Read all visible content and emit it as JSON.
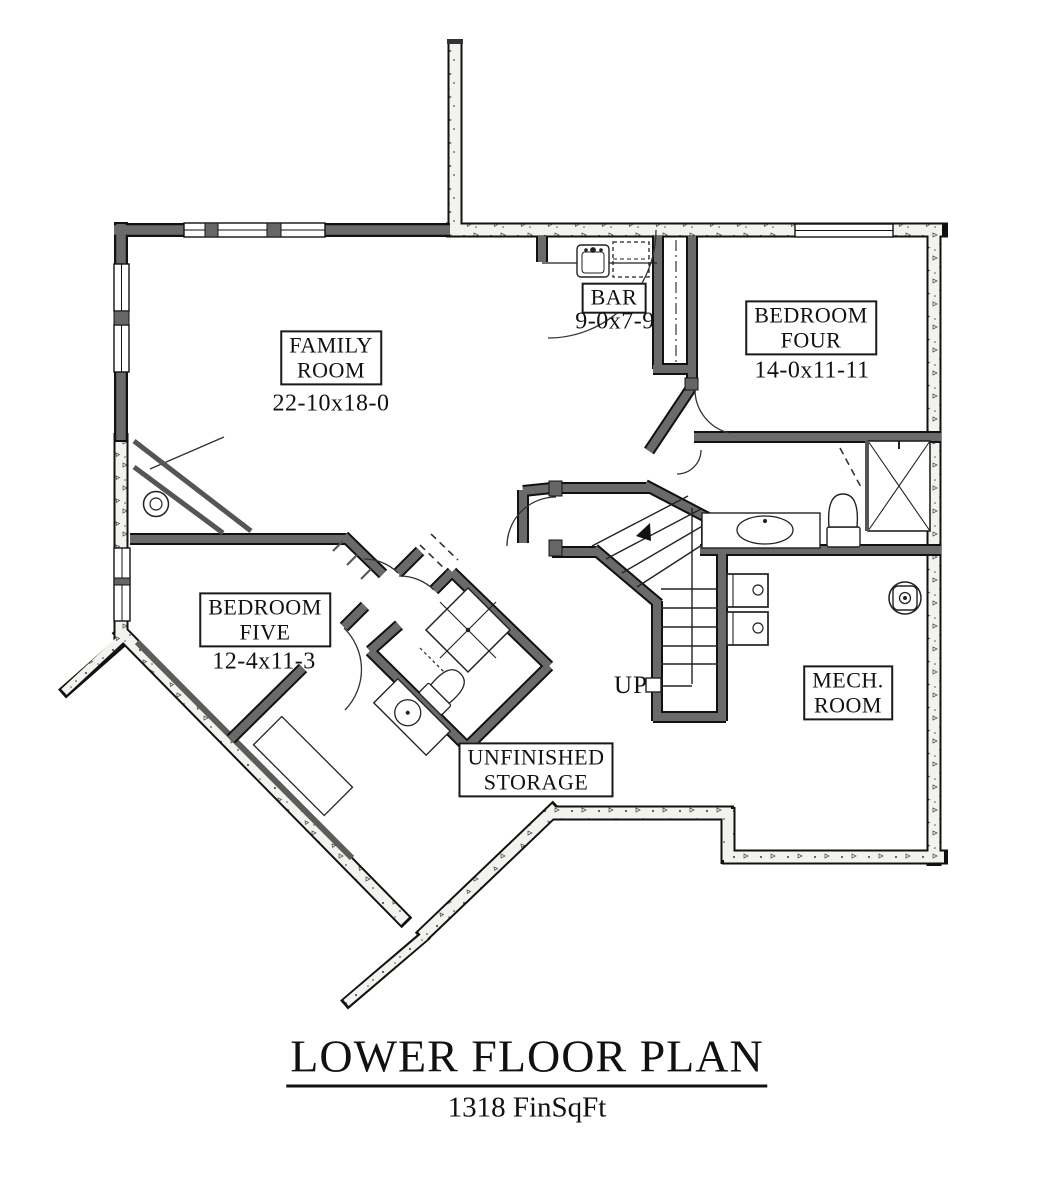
{
  "plan": {
    "title": "LOWER FLOOR PLAN",
    "area": "1318 FinSqFt",
    "up_label": "UP",
    "rooms": [
      {
        "key": "family-room",
        "lines": [
          "FAMILY",
          "ROOM"
        ],
        "dim": "22-10x18-0"
      },
      {
        "key": "bar",
        "lines": [
          "BAR"
        ],
        "dim": "9-0x7-9"
      },
      {
        "key": "bedroom-four",
        "lines": [
          "BEDROOM",
          "FOUR"
        ],
        "dim": "14-0x11-11"
      },
      {
        "key": "bedroom-five",
        "lines": [
          "BEDROOM",
          "FIVE"
        ],
        "dim": "12-4x11-3"
      },
      {
        "key": "unfinished-storage",
        "lines": [
          "UNFINISHED",
          "STORAGE"
        ],
        "dim": ""
      },
      {
        "key": "mech-room",
        "lines": [
          "MECH.",
          "ROOM"
        ],
        "dim": ""
      }
    ],
    "colors": {
      "frame_wall": "#666666",
      "concrete_fill": "#f3f2ee",
      "line": "#1a1a1a",
      "background": "#ffffff"
    }
  }
}
